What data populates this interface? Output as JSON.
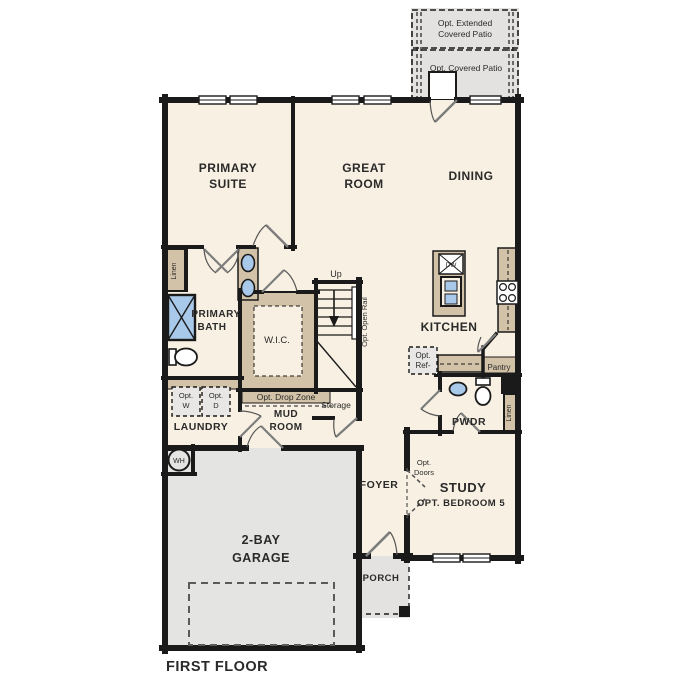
{
  "title": "FIRST FLOOR",
  "colors": {
    "wall": "#1a1a1a",
    "floor": "#f8f0e2",
    "cabinetry": "#d2c2a7",
    "outdoor_concrete": "#e3e2e0",
    "garage_floor": "#e4e4e3",
    "water_fixture": "#a9c9ea",
    "door_leaf": "#7d7d7d"
  },
  "labels": {
    "patio_extended_1": "Opt. Extended",
    "patio_extended_2": "Covered Patio",
    "patio_covered": "Opt. Covered Patio",
    "primary_suite_1": "PRIMARY",
    "primary_suite_2": "SUITE",
    "great_room_1": "GREAT",
    "great_room_2": "ROOM",
    "dining": "DINING",
    "kitchen": "KITCHEN",
    "primary_bath_1": "PRIMARY",
    "primary_bath_2": "BATH",
    "wic": "W.I.C.",
    "linen": "Linen",
    "up": "Up",
    "open_rail": "Opt. Open Rail",
    "drop_zone": "Opt. Drop Zone",
    "storage": "Storage",
    "mud_room_1": "MUD",
    "mud_room_2": "ROOM",
    "laundry": "LAUNDRY",
    "opt_w_1": "Opt.",
    "opt_w_2": "W",
    "opt_d_1": "Opt.",
    "opt_d_2": "D",
    "opt_ref_1": "Opt.",
    "opt_ref_2": "Ref-",
    "pantry": "Pantry",
    "pwdr": "PWDR",
    "foyer": "FOYER",
    "porch": "PORCH",
    "study": "STUDY",
    "study_opt": "OPT. BEDROOM 5",
    "opt_doors_1": "Opt.",
    "opt_doors_2": "Doors",
    "garage_1": "2-BAY",
    "garage_2": "GARAGE",
    "wh": "WH",
    "dw": "DW",
    "first_floor": "FIRST FLOOR"
  }
}
